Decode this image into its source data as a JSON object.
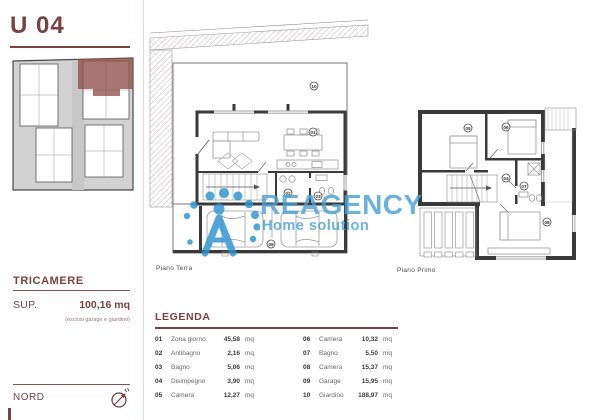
{
  "header": {
    "unit_title": "U 04"
  },
  "sidebar": {
    "type_label": "TRICAMERE",
    "sup_label": "SUP.",
    "sup_value": "100,16 mq",
    "sup_note": "(esclusi garage e giardino)",
    "north_label": "NORD"
  },
  "watermark": {
    "brand": "REAGENCY",
    "tagline": "Home solution"
  },
  "plans": {
    "terra": {
      "caption": "Piano Terra",
      "tags": {
        "giardino": "10",
        "zona_giorno": "01",
        "antibagno": "02",
        "bagno": "03",
        "garage": "09"
      }
    },
    "primo": {
      "caption": "Piano Primo",
      "tags": {
        "camera_1": "05",
        "camera_2": "06",
        "disimpegno": "04",
        "bagno": "07",
        "camera_3": "08"
      }
    }
  },
  "legend": {
    "title": "LEGENDA",
    "unit": "mq",
    "items": [
      {
        "num": "01",
        "label": "Zona giorno",
        "value": "45,58"
      },
      {
        "num": "02",
        "label": "Antibagno",
        "value": "2,16"
      },
      {
        "num": "03",
        "label": "Bagno",
        "value": "5,06"
      },
      {
        "num": "04",
        "label": "Disimpegno",
        "value": "3,90"
      },
      {
        "num": "05",
        "label": "Camera",
        "value": "12,27"
      },
      {
        "num": "06",
        "label": "Camera",
        "value": "10,32"
      },
      {
        "num": "07",
        "label": "Bagno",
        "value": "5,50"
      },
      {
        "num": "08",
        "label": "Camera",
        "value": "15,37"
      },
      {
        "num": "09",
        "label": "Garage",
        "value": "15,95"
      },
      {
        "num": "10",
        "label": "Giardino",
        "value": "188,97"
      }
    ]
  },
  "colors": {
    "accent": "#7a4141",
    "watermark_blue": "#4aa0d6",
    "site_highlight": "#8e5048"
  }
}
